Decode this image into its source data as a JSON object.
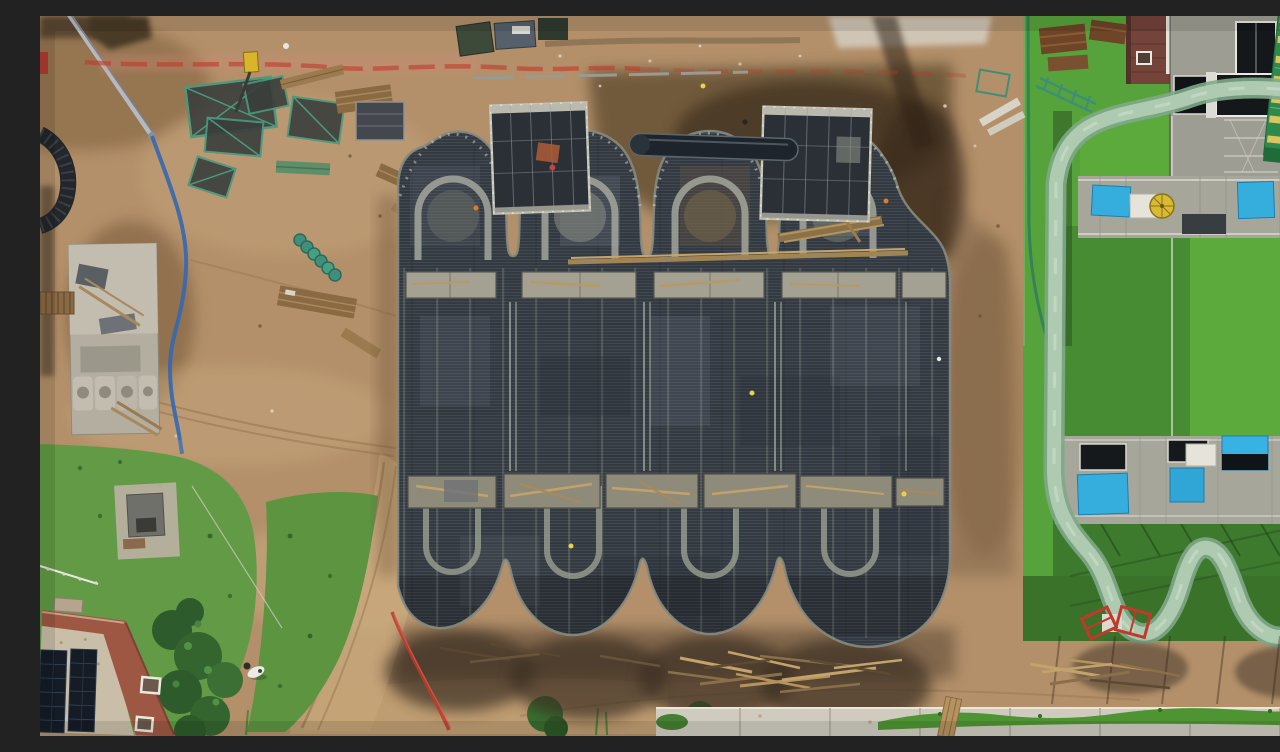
{
  "photo": {
    "kind": "aerial-drone-photo",
    "width_px": 1280,
    "height_px": 720,
    "alt": "Top-down drone view of a water-park construction site: a dark four-lobed concrete formwork slab surrounded by bare earth, next to an identical finished building with a green roof lawn, pale green water-slide flume, pool terrace with bright blue panels, a grandstand, a brick service house, and a terracotta building with rooftop solar panels."
  },
  "scene": {
    "regions": {
      "background_dirt": {
        "label": "Graded bare earth across the construction site"
      },
      "excavation": {
        "label": "Dark excavated trench along the top edge of the slab"
      },
      "haul_road": {
        "label": "Dirt haul roads with tire tracks"
      },
      "laydown_yard": {
        "label": "Lay-down yard with scaffold frames, lumber and drum stacks"
      },
      "safety_tape": {
        "label": "Red safety barrier tape line"
      },
      "pump_line": {
        "label": "Silver concrete pump boom with blue delivery hose"
      },
      "storage_pad": {
        "label": "Concrete storage pad with precast moulds and planks"
      },
      "culvert_pipe": {
        "label": "Large dark culvert pipe at the left edge"
      },
      "slab": {
        "label": "Dark waffle formwork slab with four arched lobes under construction"
      },
      "arch_rings": {
        "label": "Light formwork arch rings on the slab"
      },
      "tie_beam_rows": {
        "label": "Rows of open formwork boxes across the slab"
      },
      "scaffold_tower_west": {
        "label": "Western scaffold formwork tower"
      },
      "scaffold_tower_east": {
        "label": "Eastern scaffold formwork tower"
      },
      "steel_tank": {
        "label": "Steel pipe section staged between the towers"
      },
      "timber_beam": {
        "label": "Long timber walers laid across the slab"
      },
      "workers": {
        "label": "Workers in hi-vis vests on and around the slab"
      },
      "finished_park": {
        "label": "Completed twin building with green roof and scalloped edge"
      },
      "lawn": {
        "label": "Green roof lawn"
      },
      "slide_flume": {
        "label": "Pale green water-slide flume winding over the lawn"
      },
      "pool_terrace_upper": {
        "label": "Upper pool terrace with blue panels and umbrella"
      },
      "pool_terrace_lower": {
        "label": "Lower pool terrace with blue panels and skylights"
      },
      "umbrella": {
        "label": "Yellow patio umbrella"
      },
      "brick_house": {
        "label": "Brick service building"
      },
      "roof_terrace": {
        "label": "Concrete roof terrace with dark skylights"
      },
      "grandstand": {
        "label": "Green grandstand with yellow steps"
      },
      "perimeter_pipe": {
        "label": "Green perimeter pipe and fence line"
      },
      "red_frames": {
        "label": "Red steel frames dropped on the ground"
      },
      "red_hose": {
        "label": "Red hose crossing the dirt"
      },
      "debris": {
        "label": "Piles of stripped formwork timber"
      },
      "sidewalk": {
        "label": "White boundary wall and sidewalk along the bottom"
      },
      "verge": {
        "label": "Grass verge along the boundary wall"
      },
      "solar_house": {
        "label": "Terracotta building with rooftop solar panels"
      },
      "trees": {
        "label": "Dense trees beside the solar house"
      },
      "pasture": {
        "label": "Grassy yard with a grazing white animal"
      },
      "animal": {
        "label": "White animal grazing"
      },
      "shed": {
        "label": "Small grey shed on a concrete pad"
      },
      "vehicles": {
        "label": "Site vehicles parked at the top edge"
      },
      "drill_rig": {
        "label": "Small yellow rig near the red tape"
      },
      "shadows": {
        "label": "Shadows cast by the slab, flume and buildings"
      }
    },
    "counts": {
      "top_arch_lobes": 4,
      "bottom_scallop_lobes": 4,
      "scaffold_towers": 2,
      "workers_hi_vis": 6,
      "blue_pool_panels": 7,
      "teal_scaffold_frames": 5
    }
  },
  "palette": {
    "dirt": "#b3906a",
    "dirt_dark": "#6b5438",
    "slab_dark": "#343a42",
    "slab_light": "#a3a79c",
    "grass": "#57a33b",
    "grass_dark": "#2c5f25",
    "flume": "#aecbb2",
    "flume_edge": "#7fa98a",
    "pool_blue": "#35aede",
    "safety_red": "#c0392b",
    "brick": "#74433a",
    "terracotta": "#9e5743",
    "solar_panel": "#151c26",
    "sidewalk": "#cfccbf",
    "grandstand_green": "#2e8a4c",
    "grandstand_yellow": "#d9c660",
    "hi_vis_yellow": "#e8d24a",
    "hi_vis_orange": "#e07b2a",
    "scaffold_teal": "#49997f",
    "lumber": "#8a6a42"
  }
}
